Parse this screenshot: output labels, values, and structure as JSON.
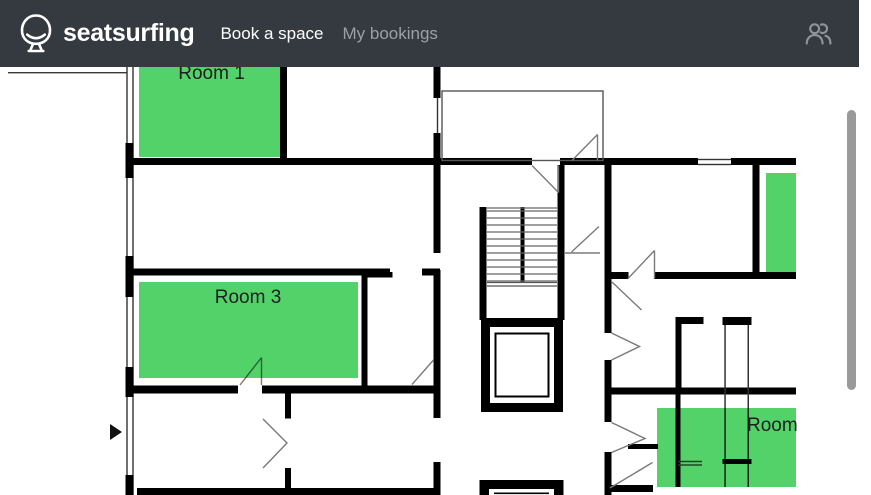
{
  "navbar": {
    "brand": "seatsurfing",
    "links": [
      {
        "label": "Book a space",
        "active": true
      },
      {
        "label": "My bookings",
        "active": false
      }
    ],
    "bg_color": "#343a40",
    "active_link_color": "#ffffff",
    "inactive_link_color": "#9aa0a5",
    "icons": {
      "brand": "seatsurfing-logo-icon",
      "right": "people-icon"
    }
  },
  "floorplan": {
    "available_color": "#52d269",
    "wall_color": "#000000",
    "marker_icon": "position-marker-icon",
    "rooms": [
      {
        "id": "room-1",
        "label": "Room 1",
        "status": "available"
      },
      {
        "id": "room-3",
        "label": "Room 3",
        "status": "available"
      },
      {
        "id": "room-right-strip",
        "label": "",
        "status": "available"
      },
      {
        "id": "room-bottom-right",
        "label": "Room",
        "status": "available"
      }
    ]
  },
  "scrollbar": {
    "thumb_color": "#9a9a9a"
  }
}
